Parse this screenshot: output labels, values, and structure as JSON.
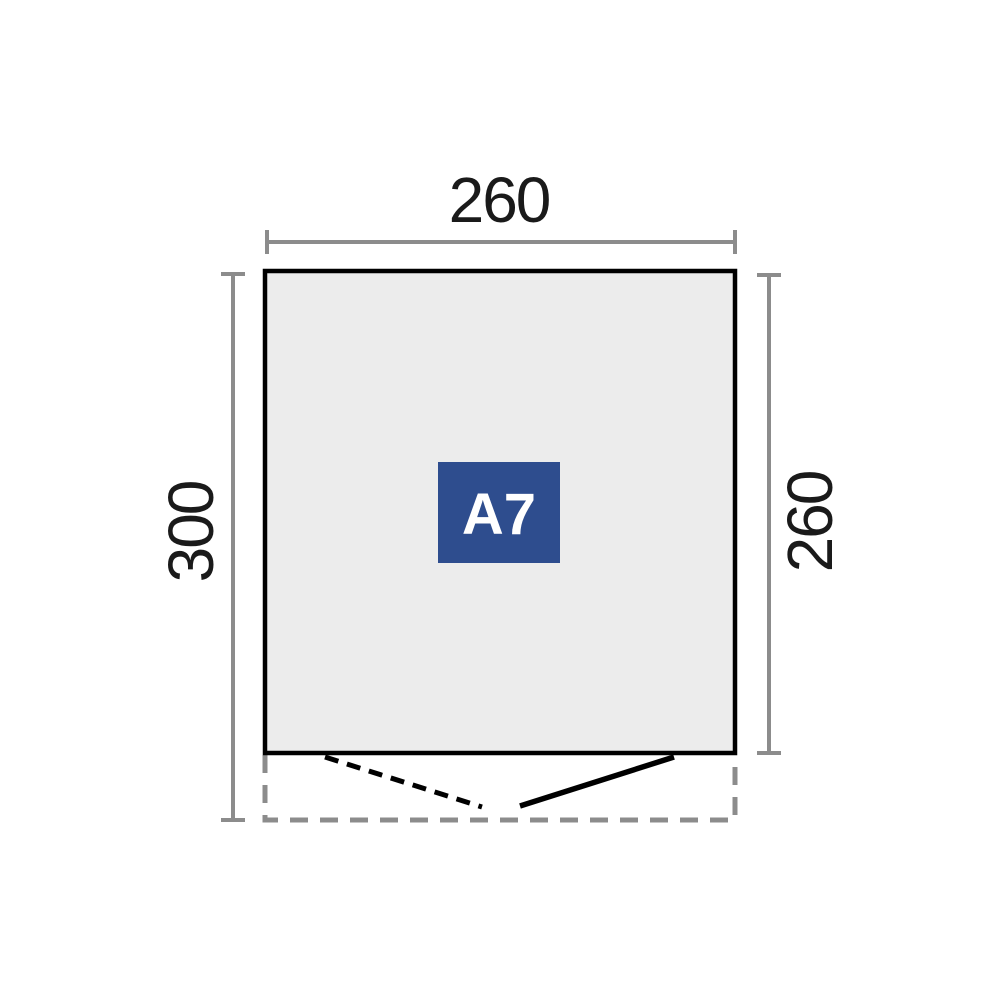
{
  "diagram": {
    "title": "shed-floor-plan",
    "model_badge": {
      "label": "A7"
    },
    "measurements": {
      "top_width": {
        "value": "260"
      },
      "left_depth": {
        "value": "300"
      },
      "right_depth": {
        "value": "260"
      }
    },
    "colors": {
      "floor_fill": "#ececec",
      "wall_outline": "#000000",
      "dimension_gray": "#8c8c8c",
      "badge_background": "#2e4d8e",
      "badge_text": "#ffffff"
    }
  }
}
